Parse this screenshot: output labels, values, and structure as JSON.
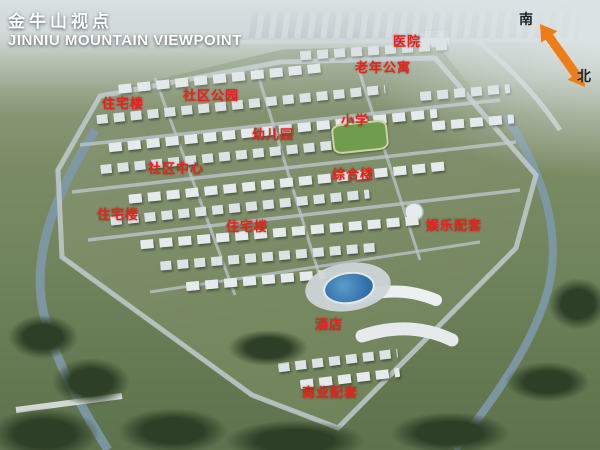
{
  "title": {
    "zh": "金牛山视点",
    "en": "JINNIU MOUNTAIN VIEWPOINT"
  },
  "compass": {
    "south_label": "南",
    "north_label": "北"
  },
  "colors": {
    "label_red": "#e6231a",
    "arrow_orange": "#ee7d18",
    "title_white": "#ffffff",
    "water_blue": "#7e99aa",
    "pond_blue": "#2e6da8"
  },
  "labels": [
    {
      "text": "医院",
      "x": 393,
      "y": 31
    },
    {
      "text": "老年公寓",
      "x": 355,
      "y": 57
    },
    {
      "text": "社区公园",
      "x": 183,
      "y": 85
    },
    {
      "text": "住宅楼",
      "x": 102,
      "y": 93
    },
    {
      "text": "小学",
      "x": 341,
      "y": 110
    },
    {
      "text": "幼儿园",
      "x": 252,
      "y": 124
    },
    {
      "text": "社区中心",
      "x": 148,
      "y": 158
    },
    {
      "text": "综合楼",
      "x": 332,
      "y": 164
    },
    {
      "text": "住宅楼",
      "x": 97,
      "y": 204
    },
    {
      "text": "住宅楼",
      "x": 226,
      "y": 216
    },
    {
      "text": "娱乐配套",
      "x": 426,
      "y": 215
    },
    {
      "text": "酒店",
      "x": 315,
      "y": 314
    },
    {
      "text": "商业配套",
      "x": 302,
      "y": 382
    }
  ]
}
